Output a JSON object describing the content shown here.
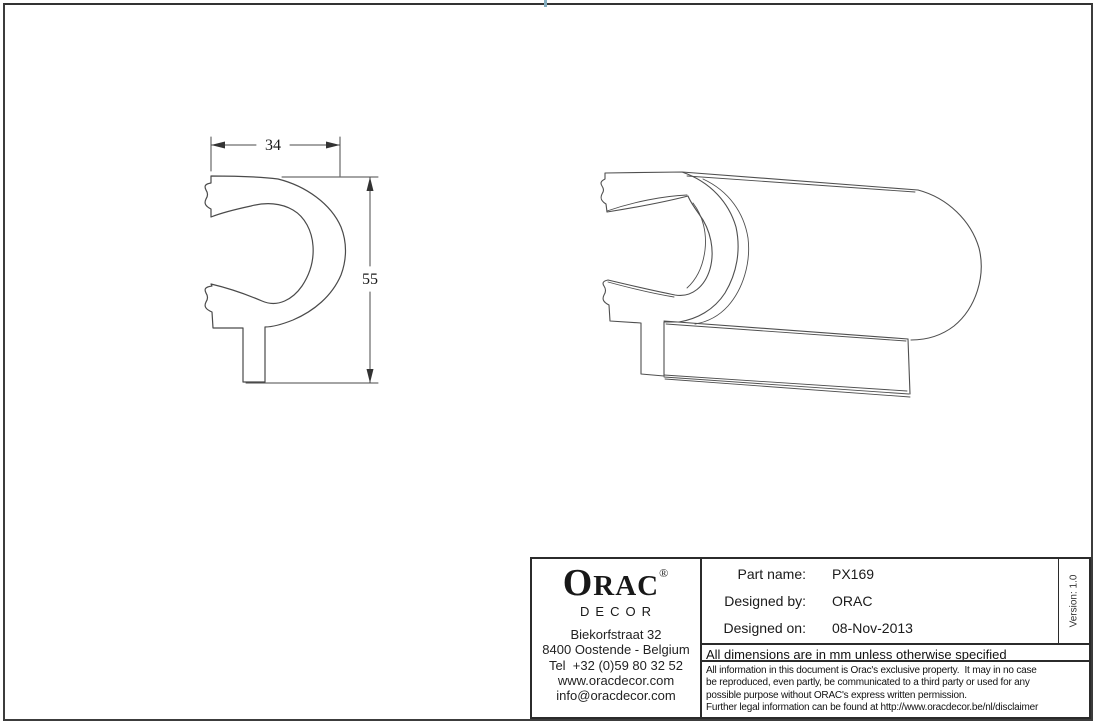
{
  "sheet": {
    "background": "#ffffff",
    "frame_color": "#3c3c3c",
    "line_color": "#4f4f4f",
    "tick_color": "#85aec0"
  },
  "drawing": {
    "width_dim": "34",
    "height_dim": "55"
  },
  "title_block": {
    "logo": {
      "initial": "O",
      "rest": "RAC",
      "registered": "®",
      "subtitle": "DECOR"
    },
    "address": [
      "Biekorfstraat 32",
      "8400 Oostende - Belgium",
      "Tel  +32 (0)59 80 32 52",
      "www.oracdecor.com",
      "info@oracdecor.com"
    ],
    "fields": [
      {
        "label": "Part name:",
        "value": "PX169"
      },
      {
        "label": "Designed by:",
        "value": "ORAC"
      },
      {
        "label": "Designed on:",
        "value": "08-Nov-2013"
      }
    ],
    "version": "Version: 1.0",
    "dimensions_note": "All dimensions are in mm unless otherwise specified",
    "legal": [
      "All information in this document is Orac's exclusive property.  It may in no case",
      "be reproduced, even partly, be communicated to a third party or used for any",
      "possible purpose without ORAC's express written permission.",
      "Further legal information can be found at http://www.oracdecor.be/nl/disclaimer"
    ]
  }
}
